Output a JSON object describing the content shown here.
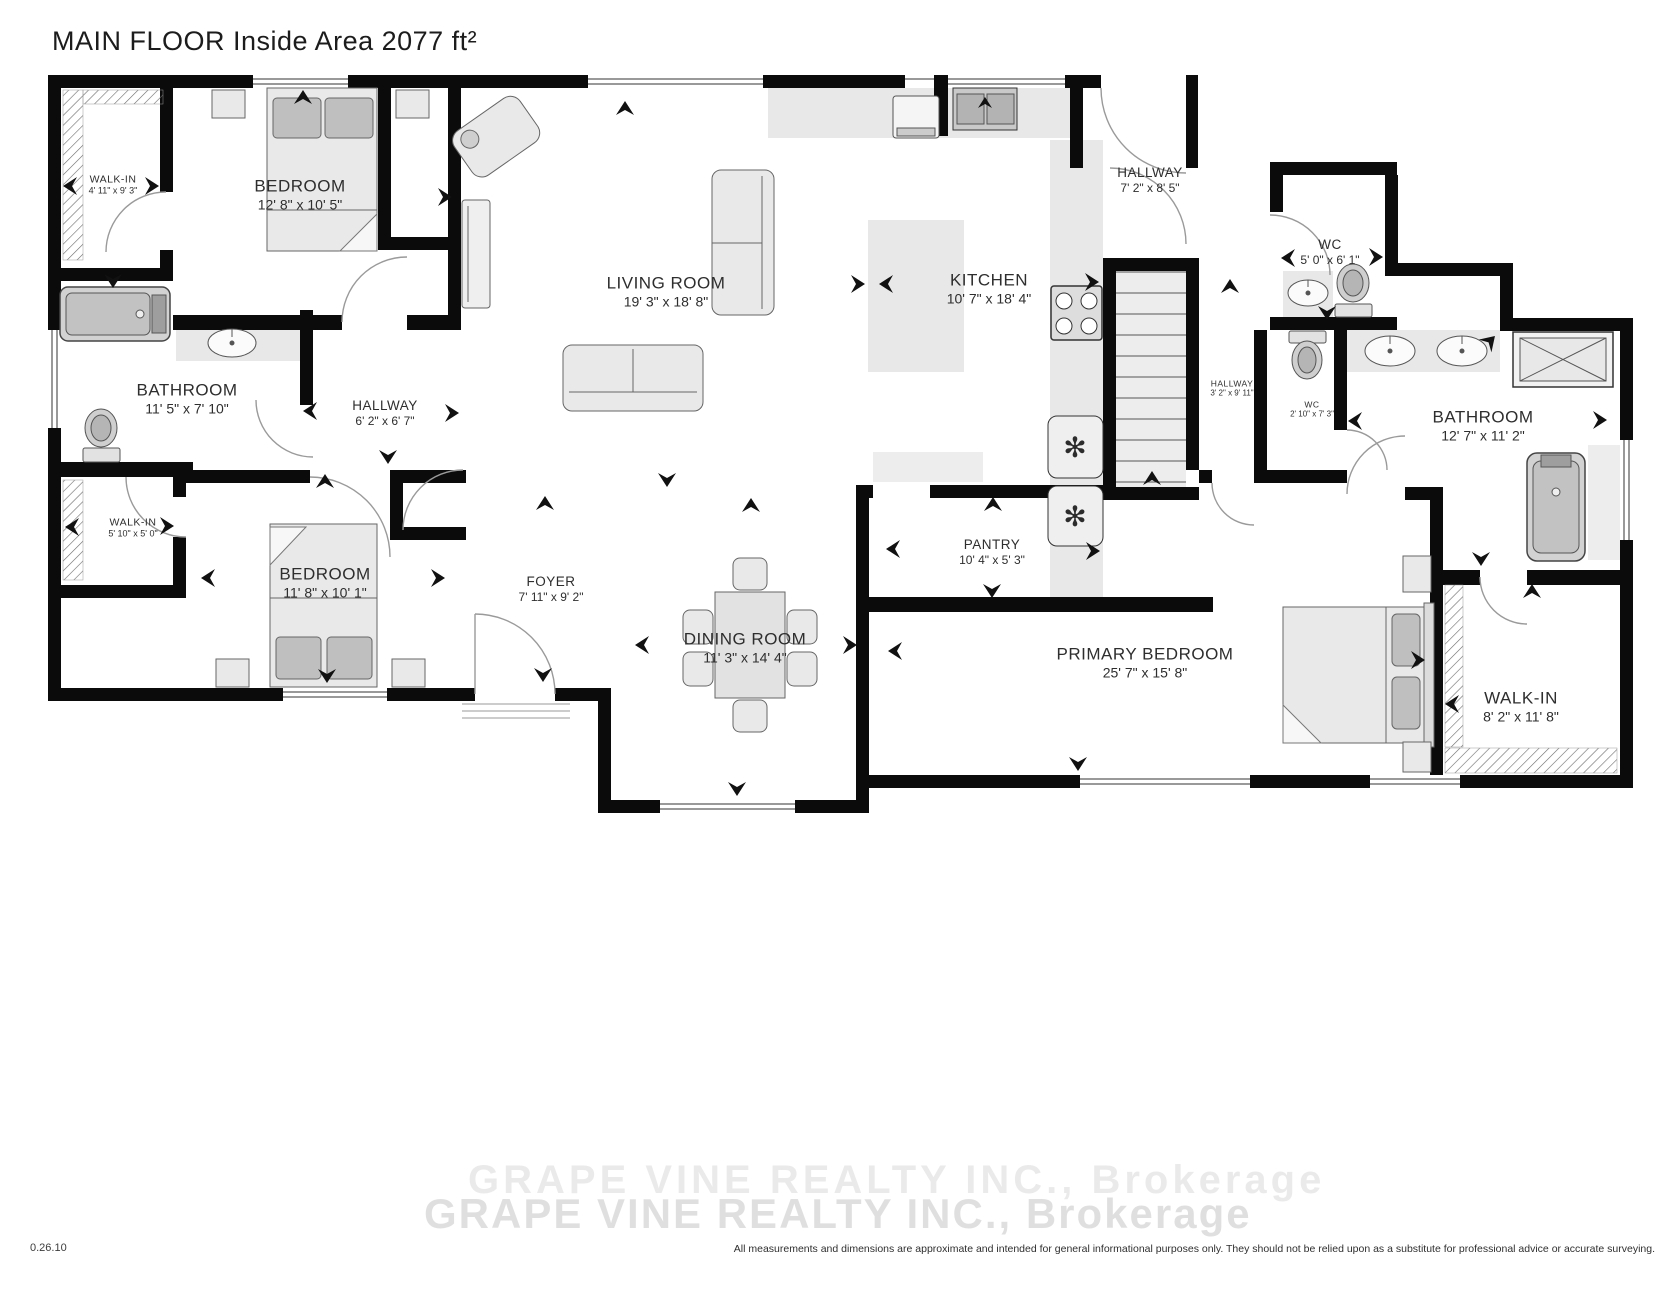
{
  "title": "MAIN FLOOR Inside Area 2077 ft²",
  "rooms": [
    {
      "name": "WALK-IN",
      "dims": "4' 11\" x 9' 3\""
    },
    {
      "name": "BEDROOM",
      "dims": "12' 8\" x 10' 5\""
    },
    {
      "name": "LIVING ROOM",
      "dims": "19' 3\" x 18' 8\""
    },
    {
      "name": "HALLWAY",
      "dims": "7' 2\" x 8' 5\""
    },
    {
      "name": "KITCHEN",
      "dims": "10' 7\" x 18' 4\""
    },
    {
      "name": "WC",
      "dims": "5' 0\" x 6' 1\""
    },
    {
      "name": "BATHROOM",
      "dims": "11' 5\" x 7' 10\""
    },
    {
      "name": "HALLWAY",
      "dims": "6' 2\" x 6' 7\""
    },
    {
      "name": "HALLWAY",
      "dims": "3' 2\" x 9' 11\""
    },
    {
      "name": "WC",
      "dims": "2' 10\" x 7' 3\""
    },
    {
      "name": "BATHROOM",
      "dims": "12' 7\" x 11' 2\""
    },
    {
      "name": "WALK-IN",
      "dims": "5' 10\" x 5' 0\""
    },
    {
      "name": "BEDROOM",
      "dims": "11' 8\" x 10' 1\""
    },
    {
      "name": "FOYER",
      "dims": "7' 11\" x 9' 2\""
    },
    {
      "name": "DINING ROOM",
      "dims": "11' 3\" x 14' 4\""
    },
    {
      "name": "PANTRY",
      "dims": "10' 4\" x 5' 3\""
    },
    {
      "name": "PRIMARY BEDROOM",
      "dims": "25' 7\" x 15' 8\""
    },
    {
      "name": "WALK-IN",
      "dims": "8' 2\" x 11' 8\""
    }
  ],
  "watermark": {
    "line1": "GRAPE VINE REALTY INC., Brokerage",
    "line2": "GRAPE VINE REALTY INC., Brokerage"
  },
  "footer": {
    "code": "0.26.10",
    "disclaimer": "All measurements and dimensions are approximate and intended for general informational purposes only. They should not be relied upon as a substitute for professional advice or accurate surveying."
  }
}
